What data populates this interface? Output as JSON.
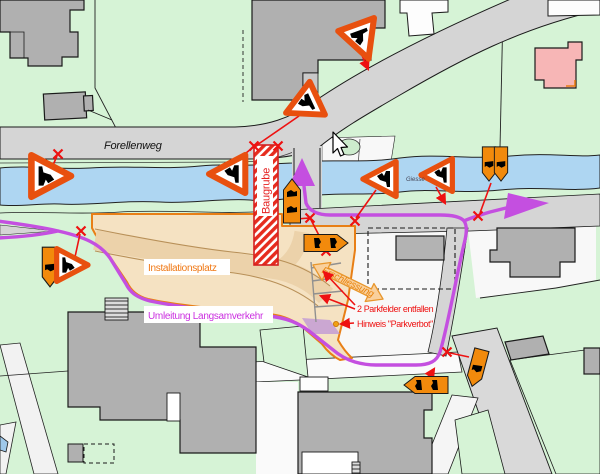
{
  "map": {
    "street_label": "Forellenweg",
    "river_label": "Giesse",
    "zone_labels": {
      "baugrube": "Baugrube",
      "installationsplatz": "Installationsplatz",
      "umleitung": "Umleitung Langsamverkehr",
      "erschliessung": "Erschliessung"
    },
    "annotations": {
      "parking_note": "2 Parkfelder entfallen",
      "parkverbot_note": "Hinweis \"Parkverbot\""
    },
    "colors": {
      "parcel_green": "#d6f3d6",
      "road_gray": "#d5d5d5",
      "building_gray": "#b3b3b3",
      "building_pink": "#f7b6b6",
      "river_blue": "#aed6f2",
      "detour_purple": "#c44fe0",
      "baugrube_red": "#e62c1e",
      "installation_tan": "#f5e2c2",
      "sign_orange": "#f28a0c",
      "warning_triangle_orange": "#e8500f",
      "marker_red": "#ee1111"
    },
    "signs": {
      "warning_triangle_count": 7,
      "detour_arrow_count": 7
    }
  }
}
